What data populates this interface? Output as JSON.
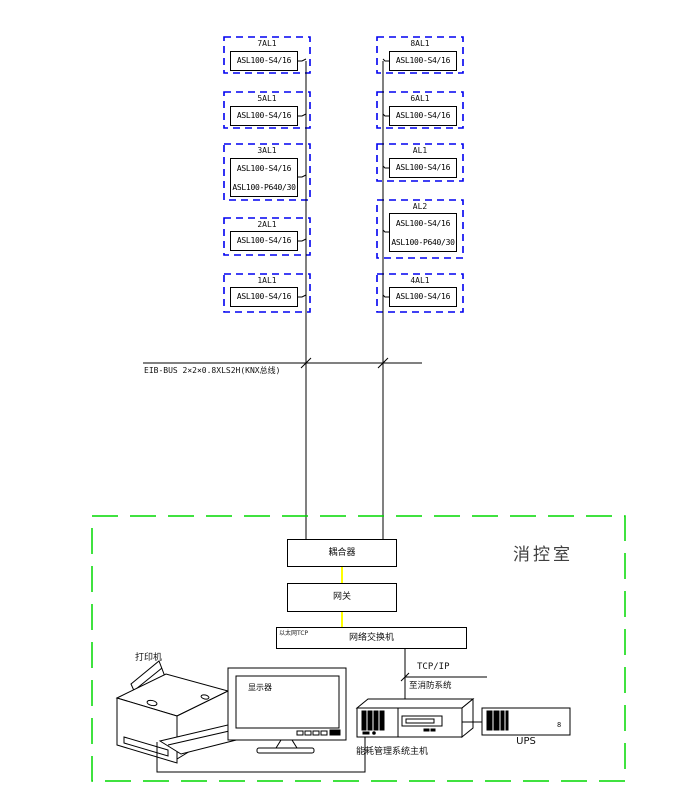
{
  "panels": {
    "left": [
      {
        "title": "7AL1",
        "lines": [
          "ASL100-S4/16"
        ]
      },
      {
        "title": "5AL1",
        "lines": [
          "ASL100-S4/16"
        ]
      },
      {
        "title": "3AL1",
        "lines": [
          "ASL100-S4/16",
          "ASL100-P640/30"
        ]
      },
      {
        "title": "2AL1",
        "lines": [
          "ASL100-S4/16"
        ]
      },
      {
        "title": "1AL1",
        "lines": [
          "ASL100-S4/16"
        ]
      }
    ],
    "right": [
      {
        "title": "8AL1",
        "lines": [
          "ASL100-S4/16"
        ]
      },
      {
        "title": "6AL1",
        "lines": [
          "ASL100-S4/16"
        ]
      },
      {
        "title": "AL1",
        "lines": [
          "ASL100-S4/16"
        ]
      },
      {
        "title": "AL2",
        "lines": [
          "ASL100-S4/16",
          "ASL100-P640/30"
        ]
      },
      {
        "title": "4AL1",
        "lines": [
          "ASL100-S4/16"
        ]
      }
    ]
  },
  "bus": {
    "label": "EIB-BUS  2×2×0.8XLS2H(KNX总线)"
  },
  "room": {
    "label": "消控室"
  },
  "devices": {
    "coupler": "耦合器",
    "gateway": "网关",
    "switch": "网络交换机",
    "switch_tag": "以太网TCP",
    "tcpip": "TCP/IP",
    "fire_link": "至消防系统",
    "printer": "打印机",
    "monitor": "显示器",
    "host": "能耗管理系统主机",
    "ups": "UPS",
    "ups_mark": "8"
  },
  "colors": {
    "dashed_box": "#0000f0",
    "room_border": "#00d800",
    "cable_yellow": "#ffff00",
    "line": "#000000"
  }
}
